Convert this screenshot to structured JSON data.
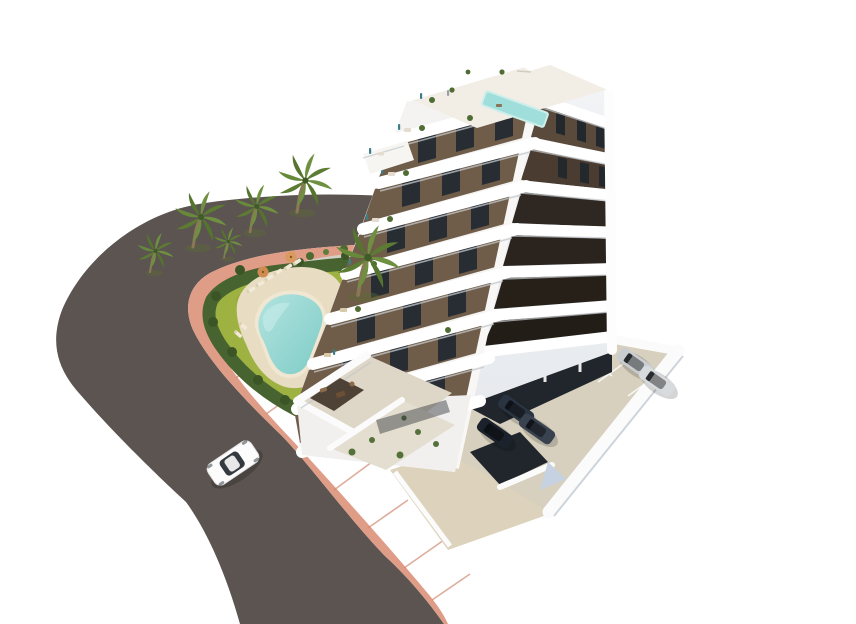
{
  "scene": {
    "description": "Aerial 3D architectural rendering of a modern white apartment block with tiered rounded balconies, rooftop plunge pool, landscaped garden with free-form swimming pool and sun loungers, palm trees, dark hedge border, pink perimeter sidewalk, curved asphalt road with a single white car, and a white-walled parking lot with parked cars.",
    "elements": [
      "road",
      "sidewalk",
      "garden",
      "swimming-pool",
      "sun-loungers",
      "parasols",
      "palm-trees",
      "hedge",
      "apartment-building",
      "balconies",
      "rooftop-pool",
      "ground-terraces",
      "parking-lot",
      "parked-cars",
      "white-car",
      "driveway"
    ]
  },
  "counts": {
    "moving_cars": 1,
    "parked_cars": 5,
    "palm_trees": 6,
    "visible_floor_bands": 7,
    "parasols": 2,
    "sun_loungers": 8
  },
  "palette": {
    "background": "#ffffff",
    "road": "#5b5450",
    "sidewalk": "#df9c86",
    "sidewalk_shade": "#cf8a72",
    "hedge": "#47632f",
    "lawn": "#9eb242",
    "lawn_dark": "#84992f",
    "gravel": "#d2cfc6",
    "pool_deck": "#e8dcc2",
    "pool_coping": "#f0e7d2",
    "pool_water": "#8fd3cf",
    "pool_water_light": "#bde8e5",
    "palm_frond": "#5d7c33",
    "palm_frond_light": "#6e9040",
    "palm_trunk": "#8d7657",
    "building_white": "#f4f3f1",
    "slab_white": "#ffffff",
    "slab_shadow": "#c3c8cc",
    "facade_brown": "#6f5c49",
    "facade_brown_dark": "#57473a",
    "glazing_dark": "#272d33",
    "recess_dark": "#2b241e",
    "right_face": "#eef0f3",
    "roof_deck": "#f2eee6",
    "rooftop_pool": "#9fdeda",
    "rooftop_pool_rim": "#cdeeea",
    "terrace_floor": "#ded6c6",
    "pergola": "#41352a",
    "parking_floor": "#d7d0be",
    "garage_dark": "#20262c",
    "garage_ceiling": "#b9bdc2",
    "wall_white": "#fbfbfb",
    "ramp_blue": "#c6d1e1",
    "car_white": "#fcfcfc",
    "car_glass": "#343a40",
    "car_silver": "#c9cdd2",
    "car_silver2": "#d8dbde",
    "car_dark": "#2a3340",
    "car_dark2": "#1b222b",
    "car_dark3": "#39424f",
    "parasol": "#cf8c51",
    "parasol2": "#d89a5e",
    "people_teal": "#3d7d88"
  }
}
